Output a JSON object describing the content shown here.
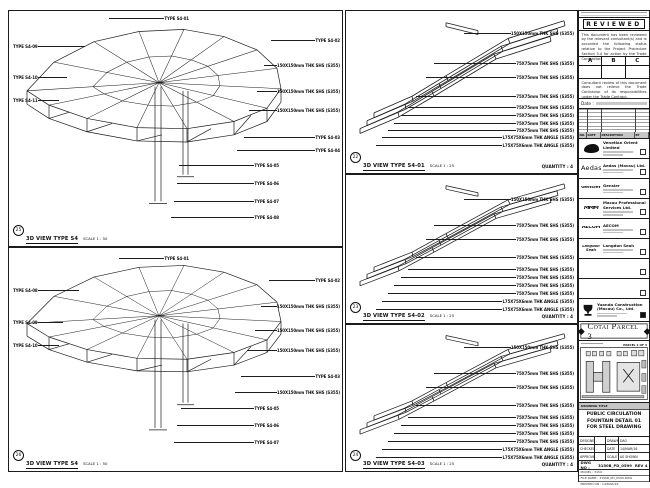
{
  "panels": [
    {
      "view": "3D VIEW TYPE S4",
      "scale": "SCALE 1 : 50",
      "bubble": "25",
      "qty": "",
      "ann_left": [
        {
          "top": 33,
          "left": 4,
          "width": 72,
          "text": "TYPE S4-09"
        },
        {
          "top": 64,
          "left": 4,
          "width": 54,
          "text": "TYPE S4-10"
        },
        {
          "top": 87,
          "left": 4,
          "width": 46,
          "text": "TYPE S4-11"
        }
      ],
      "ann_right": [
        {
          "top": 5,
          "left": 100,
          "width": 80,
          "text": "TYPE S4-01"
        },
        {
          "top": 27,
          "left": 262,
          "width": 69,
          "text": "TYPE S4-02"
        },
        {
          "top": 52,
          "left": 255,
          "width": 76,
          "text": "150X150mm THK SHS (S355)"
        },
        {
          "top": 78,
          "left": 248,
          "width": 83,
          "text": "150X150mm THK SHS (S355)"
        },
        {
          "top": 97,
          "left": 240,
          "width": 91,
          "text": "150X150mm THK SHS (S355)"
        },
        {
          "top": 124,
          "left": 235,
          "width": 96,
          "text": "TYPE S4-03"
        },
        {
          "top": 137,
          "left": 228,
          "width": 103,
          "text": "TYPE S4-04"
        },
        {
          "top": 152,
          "left": 170,
          "width": 100,
          "text": "TYPE S4-05"
        },
        {
          "top": 170,
          "left": 168,
          "width": 102,
          "text": "TYPE S4-06"
        },
        {
          "top": 188,
          "left": 165,
          "width": 105,
          "text": "TYPE S4-07"
        },
        {
          "top": 204,
          "left": 162,
          "width": 108,
          "text": "TYPE S4-08"
        }
      ]
    },
    {
      "view": "3D VIEW TYPE S4",
      "scale": "SCALE 1 : 50",
      "bubble": "26",
      "qty": "",
      "ann_left": [
        {
          "top": 40,
          "left": 4,
          "width": 66,
          "text": "TYPE S4-08"
        },
        {
          "top": 72,
          "left": 4,
          "width": 50,
          "text": "TYPE S4-09"
        },
        {
          "top": 95,
          "left": 4,
          "width": 46,
          "text": "TYPE S4-10"
        }
      ],
      "ann_right": [
        {
          "top": 8,
          "left": 110,
          "width": 70,
          "text": "TYPE S4-01"
        },
        {
          "top": 30,
          "left": 260,
          "width": 71,
          "text": "TYPE S4-02"
        },
        {
          "top": 56,
          "left": 252,
          "width": 79,
          "text": "150X150mm THK SHS (S355)"
        },
        {
          "top": 80,
          "left": 246,
          "width": 85,
          "text": "150X150mm THK SHS (S355)"
        },
        {
          "top": 100,
          "left": 238,
          "width": 93,
          "text": "150X150mm THK SHS (S355)"
        },
        {
          "top": 126,
          "left": 232,
          "width": 99,
          "text": "TYPE S4-03"
        },
        {
          "top": 142,
          "left": 226,
          "width": 105,
          "text": "150X150mm THK SHS (S355)"
        },
        {
          "top": 158,
          "left": 172,
          "width": 98,
          "text": "TYPE S4-05"
        },
        {
          "top": 175,
          "left": 168,
          "width": 102,
          "text": "TYPE S4-06"
        },
        {
          "top": 192,
          "left": 165,
          "width": 105,
          "text": "TYPE S4-07"
        }
      ]
    },
    {
      "view": "3D VIEW TYPE S4-01",
      "scale": "SCALE 1 : 25",
      "bubble": "22",
      "qty": "QUANTITY : 4",
      "ann_left": [],
      "ann_right": [
        {
          "top": 20,
          "left": 118,
          "width": 110,
          "text": "150X150mm THK SHS (S355)"
        },
        {
          "top": 50,
          "left": 88,
          "width": 140,
          "text": "75X75mm THK SHS (S355)"
        },
        {
          "top": 64,
          "left": 80,
          "width": 148,
          "text": "75X75mm THK SHS (S355)"
        },
        {
          "top": 83,
          "left": 70,
          "width": 158,
          "text": "75X75mm THK SHS (S355)"
        },
        {
          "top": 94,
          "left": 62,
          "width": 166,
          "text": "75X75mm THK SHS (S355)"
        },
        {
          "top": 102,
          "left": 55,
          "width": 173,
          "text": "75X75mm THK SHS (S355)"
        },
        {
          "top": 110,
          "left": 48,
          "width": 180,
          "text": "75X75mm THK SHS (S355)"
        },
        {
          "top": 117,
          "left": 42,
          "width": 186,
          "text": "75X75mm THK SHS (S355)"
        },
        {
          "top": 124,
          "left": 36,
          "width": 192,
          "text": "L75X75X6mm THK ANGLE (S355)"
        },
        {
          "top": 132,
          "left": 30,
          "width": 198,
          "text": "L75X75X6mm THK ANGLE (S355)"
        }
      ]
    },
    {
      "view": "3D VIEW TYPE S4-02",
      "scale": "SCALE 1 : 25",
      "bubble": "23",
      "qty": "QUANTITY : 4",
      "ann_left": [],
      "ann_right": [
        {
          "top": 22,
          "left": 118,
          "width": 110,
          "text": "150X150mm THK SHS (S355)"
        },
        {
          "top": 48,
          "left": 88,
          "width": 140,
          "text": "75X75mm THK SHS (S355)"
        },
        {
          "top": 62,
          "left": 80,
          "width": 148,
          "text": "75X75mm THK SHS (S355)"
        },
        {
          "top": 80,
          "left": 70,
          "width": 158,
          "text": "75X75mm THK SHS (S355)"
        },
        {
          "top": 92,
          "left": 62,
          "width": 166,
          "text": "75X75mm THK SHS (S355)"
        },
        {
          "top": 100,
          "left": 55,
          "width": 173,
          "text": "75X75mm THK SHS (S355)"
        },
        {
          "top": 108,
          "left": 48,
          "width": 180,
          "text": "75X75mm THK SHS (S355)"
        },
        {
          "top": 116,
          "left": 42,
          "width": 186,
          "text": "75X75mm THK SHS (S355)"
        },
        {
          "top": 124,
          "left": 36,
          "width": 192,
          "text": "L75X75X6mm THK ANGLE (S355)"
        },
        {
          "top": 132,
          "left": 30,
          "width": 198,
          "text": "L75X75X6mm THK ANGLE (S355)"
        }
      ]
    },
    {
      "view": "3D VIEW TYPE S4-03",
      "scale": "SCALE 1 : 25",
      "bubble": "24",
      "qty": "QUANTITY : 4",
      "ann_left": [],
      "ann_right": [
        {
          "top": 20,
          "left": 118,
          "width": 110,
          "text": "150X150mm THK SHS (S355)"
        },
        {
          "top": 46,
          "left": 88,
          "width": 140,
          "text": "75X75mm THK SHS (S355)"
        },
        {
          "top": 60,
          "left": 80,
          "width": 148,
          "text": "75X75mm THK SHS (S355)"
        },
        {
          "top": 78,
          "left": 70,
          "width": 158,
          "text": "75X75mm THK SHS (S355)"
        },
        {
          "top": 90,
          "left": 62,
          "width": 166,
          "text": "75X75mm THK SHS (S355)"
        },
        {
          "top": 98,
          "left": 55,
          "width": 173,
          "text": "75X75mm THK SHS (S355)"
        },
        {
          "top": 106,
          "left": 48,
          "width": 180,
          "text": "75X75mm THK SHS (S355)"
        },
        {
          "top": 114,
          "left": 42,
          "width": 186,
          "text": "75X75mm THK SHS (S355)"
        },
        {
          "top": 122,
          "left": 36,
          "width": 192,
          "text": "L75X75X6mm THK ANGLE (S355)"
        },
        {
          "top": 130,
          "left": 30,
          "width": 198,
          "text": "L75X75X6mm THK ANGLE (S355)"
        }
      ]
    }
  ],
  "titleblock": {
    "reviewed_title": "REVIEWED",
    "reviewed_para1": "This document has been reviewed by the relevant consultant(s) and is accorded the following status relative to the Project Procedure Section 5.4 for action by the Trade Contractor.",
    "abc": [
      "A",
      "B",
      "C"
    ],
    "reviewed_para2": "Consultant review of this document does not relieve the Trade Contractor of its responsibilities under the Trade Contract.",
    "date_label": "Date :",
    "rev_table_headers": [
      "NO.",
      "DATE",
      "DESCRIPTION",
      "BY"
    ],
    "companies": [
      {
        "name": "Venetian Orient Limited",
        "logo": "",
        "cls": "lg-ven"
      },
      {
        "name": "Aedas (Macau) Ltd.",
        "logo": "Aedas",
        "cls": "lg-aedas"
      },
      {
        "name": "Gensler",
        "logo": "Gensler",
        "cls": "lg-gensler"
      },
      {
        "name": "Macau Professional Services Ltd.",
        "logo": "MMM",
        "cls": "lg-mmm"
      },
      {
        "name": "AECOM",
        "logo": "AECOM",
        "cls": "lg-aecom"
      },
      {
        "name": "Langdon Seah",
        "logo": "Langdon Seah",
        "cls": "lg-ls"
      },
      {
        "name": "",
        "logo": "",
        "cls": "empty"
      },
      {
        "name": "",
        "logo": "",
        "cls": "empty"
      }
    ],
    "contractor": "Yuanda Construction (Macau) Co., Ltd.",
    "project_title": "Cotai Parcel 3",
    "keyplan_label": "PARCEL 1 OF 3",
    "drawing_title_label": "DRAWING TITLE",
    "drawing_title_lines": [
      "PUBLIC CIRCULATION",
      "FOUNTAIN DETAIL 01",
      "FOR STEEL DRAWING"
    ],
    "fields": [
      {
        "l": "DESIGNED",
        "v": "-",
        "l2": "DRAWN",
        "v2": "DAO"
      },
      {
        "l": "CHECKED",
        "v": "-",
        "l2": "DATE",
        "v2": "14/MAR/16"
      },
      {
        "l": "APPROVED",
        "v": "-",
        "l2": "SCALE",
        "v2": "AS SHOWN"
      }
    ],
    "dwg_label": "DWG NO :",
    "dwg_no": "3150B_PD_0599",
    "rev_label": "REV",
    "rev": "4",
    "file_rows": [
      "MODEL : 3150",
      "FILE NAME : 3150B_PD_0599.DWG",
      "PRINTED ON : 14/MAR/16"
    ]
  }
}
